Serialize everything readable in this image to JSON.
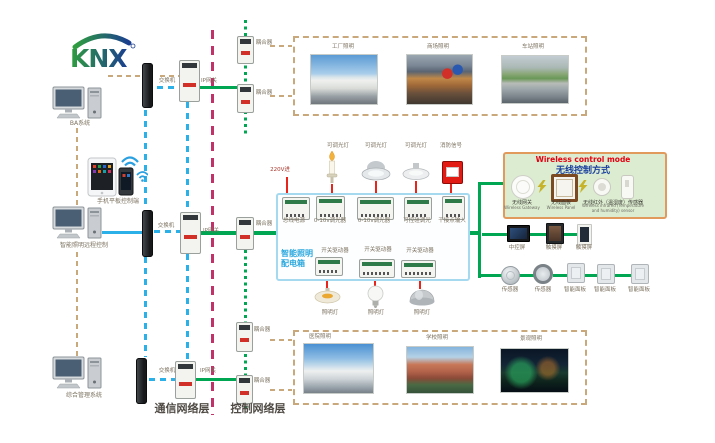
{
  "logo": {
    "text": "KNX"
  },
  "left_terminals": {
    "ba_system": "BA系统",
    "mobile_tablet": "手机平板控制端",
    "smart_lighting_remote": "智能照明远程控制",
    "integrated_management": "综合管理系统"
  },
  "network": {
    "switch": "交换机",
    "ip_gateway": "IP网关",
    "coupler": "耦合器",
    "communication_layer": "通信网络层",
    "control_layer": "控制网络层"
  },
  "applications": {
    "top": [
      "工厂照明",
      "商场照明",
      "车站照明"
    ],
    "bottom": [
      "医院照明",
      "学校照明",
      "景观照明"
    ]
  },
  "cabinet": {
    "title_line1": "智能照明",
    "title_line2": "配电箱",
    "power_in": "220V进",
    "load_labels": [
      "可调光灯",
      "可调光灯",
      "可调光灯",
      "消防信号"
    ],
    "modules": [
      "总线电源",
      "0-10v调光器",
      "0-10v调光器",
      "可控硅调光",
      "干接点输入"
    ],
    "drivers": [
      "开关驱动器",
      "开关驱动器",
      "开关驱动器"
    ],
    "lamps": [
      "照明灯",
      "照明灯",
      "照明灯"
    ]
  },
  "wireless": {
    "title_en": "Wireless control mode",
    "title_zh": "无线控制方式",
    "devices": [
      {
        "zh": "无线网关",
        "en": "Wireless Gateway"
      },
      {
        "zh": "无线面板",
        "en": "Wireless Panel"
      },
      {
        "zh": "无线红外（温湿度）传感器",
        "en": "Wireless infrared (Temperature and humidity) sensor"
      }
    ]
  },
  "right_devices": {
    "row1": [
      "中控屏",
      "触摸屏",
      "触摸屏"
    ],
    "row2": [
      "传感器",
      "传感器",
      "智能面板",
      "智能面板",
      "智能面板"
    ]
  },
  "colors": {
    "bus_green": "#00a651",
    "ethernet_blue": "#29abe2",
    "backbone_magenta": "#c03368",
    "power_red": "#e8251d",
    "link_tan": "#c9a87c",
    "cabinet_border": "#a5d9f0",
    "cabinet_title_blue": "#2ba7dd",
    "wireless_bg": "#dcecd0",
    "wireless_border": "#e2995c",
    "wireless_title_red": "#e60012",
    "wireless_title_blue": "#1a3f9e"
  }
}
